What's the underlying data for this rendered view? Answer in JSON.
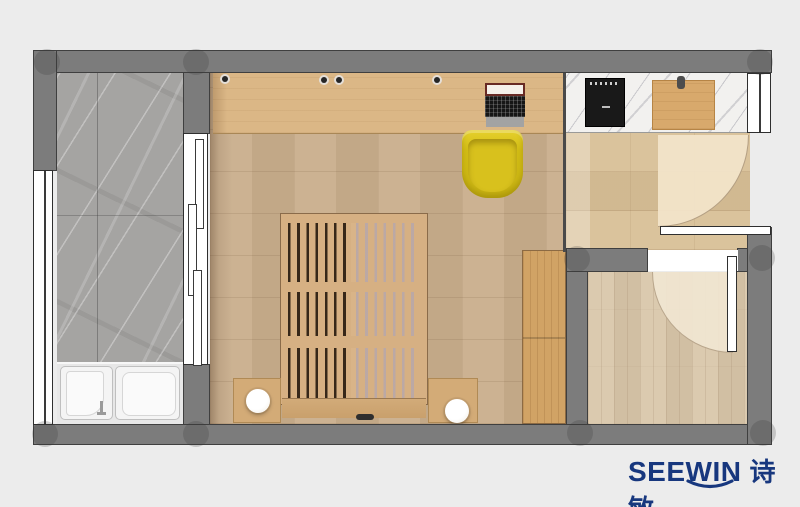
{
  "logo": {
    "latin": "SEEWIN",
    "cjk": "诗敏",
    "color": "#17377E",
    "swoosh": "smile-arc"
  },
  "palette": {
    "background": "#ECECEC",
    "wall": "#7C7C7C",
    "wall_outline": "#3F3F3F",
    "main_floor_wood": "#C9AE8C",
    "hall_floor_wood": "#D8BF96",
    "room2_floor_wood": "#D8C5A8",
    "balcony_marble_gray": "#A5A4A2",
    "counter_marble_white": "#F2F1EF",
    "desk_wood": "#DBB786",
    "bed_wood": "#D6B083",
    "wardrobe_wood": "#D1A365",
    "chair_yellow": "#D8C11D",
    "cooktop_black": "#191919",
    "appliance_white": "#F4F4F4",
    "door_swing_fill": "#F3E5CB",
    "door_leaf_white": "#FFFFFF"
  },
  "rooms": [
    {
      "id": "balcony",
      "label": "balcony laundry bay",
      "floor": "gray marble tiles"
    },
    {
      "id": "main-room",
      "label": "main living room",
      "floor": "wood planks"
    },
    {
      "id": "entry-hall",
      "label": "entry hall with kitchen counter",
      "floor": "wood planks"
    },
    {
      "id": "room2",
      "label": "secondary room",
      "floor": "wood planks"
    }
  ],
  "furniture": [
    {
      "id": "desk",
      "label": "built-in desk with open laptop"
    },
    {
      "id": "chair",
      "label": "yellow tub chair"
    },
    {
      "id": "bed",
      "label": "slatted wall bed, folded, top view"
    },
    {
      "id": "nightstand-left",
      "label": "nightstand with round lamp"
    },
    {
      "id": "nightstand-right",
      "label": "nightstand with round lamp"
    },
    {
      "id": "wardrobe",
      "label": "tall wardrobe cabinet"
    },
    {
      "id": "cooktop",
      "label": "black cooktop on marble counter"
    },
    {
      "id": "cutting-board",
      "label": "wooden board with handle"
    },
    {
      "id": "laundry-sink",
      "label": "laundry sink cabinet with faucet"
    },
    {
      "id": "washer",
      "label": "top-load washing machine"
    },
    {
      "id": "entry-door",
      "label": "entry door with quarter swing arc"
    },
    {
      "id": "room2-door",
      "label": "room door with quarter swing arc"
    }
  ]
}
